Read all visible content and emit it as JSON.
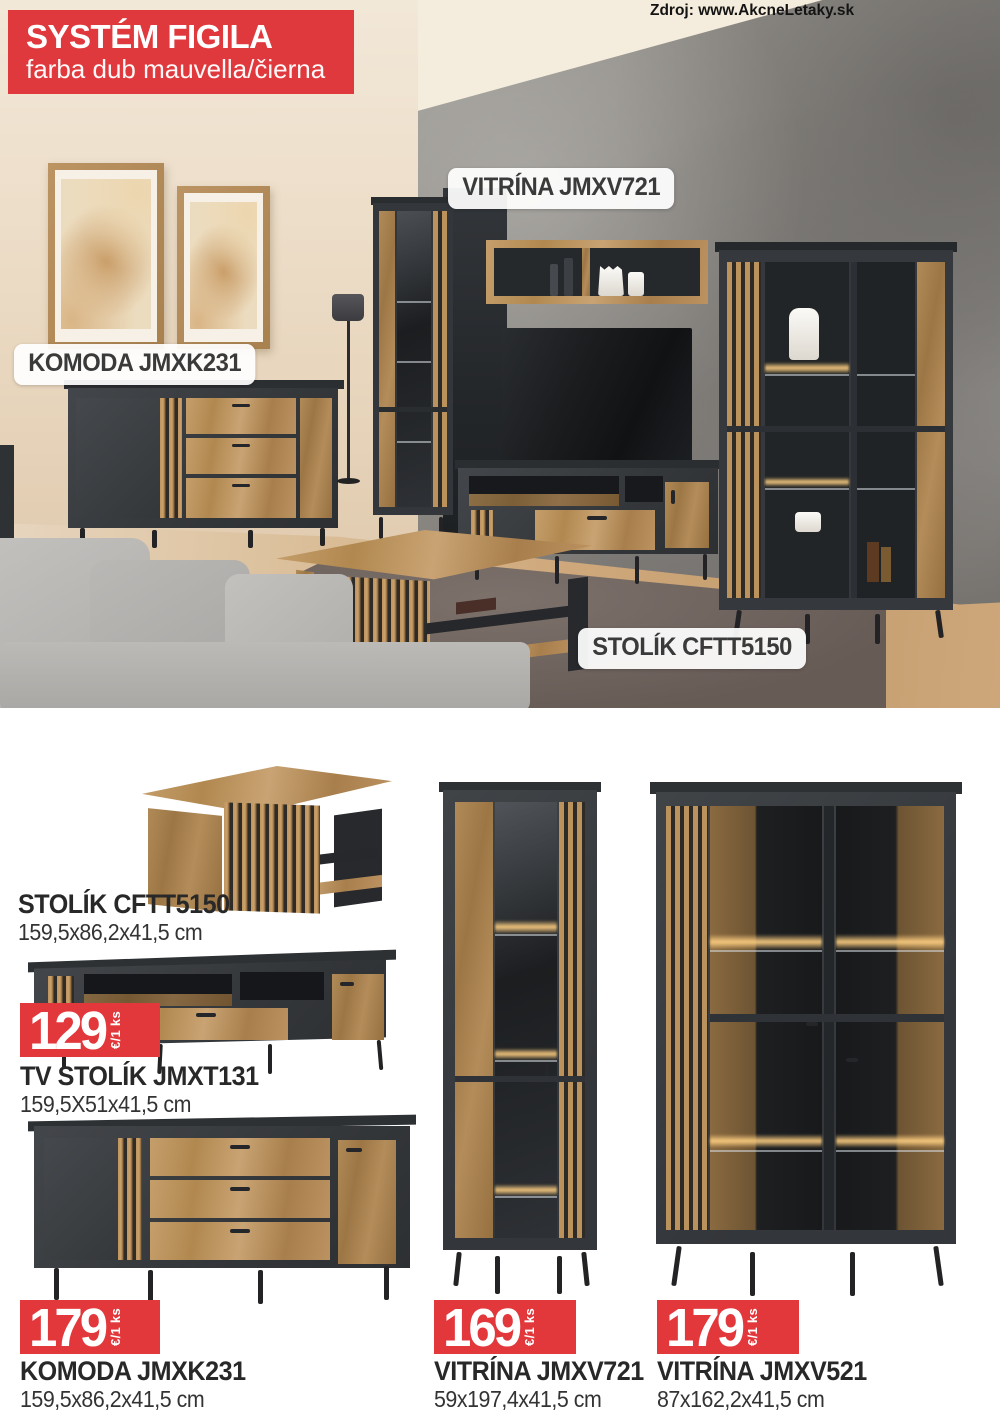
{
  "page": {
    "source_credit": "Zdroj: www.AkcneLetaky.sk"
  },
  "badge": {
    "title": "SYSTÉM FIGILA",
    "subtitle": "farba dub mauvella/čierna"
  },
  "photo": {
    "labels": [
      {
        "text": "VITRÍNA JMXV721"
      },
      {
        "text": "KOMODA JMXK231"
      },
      {
        "text": "STOLÍK CFTT5150"
      }
    ]
  },
  "products": [
    {
      "name": "STOLÍK CFTT5150",
      "dimensions": "159,5x86,2x41,5 cm"
    },
    {
      "name": "TV STOLÍK JMXT131",
      "dimensions": "159,5X51x41,5 cm",
      "price": "129",
      "price_unit": "€/1 ks"
    },
    {
      "name": "KOMODA JMXK231",
      "dimensions": "159,5x86,2x41,5 cm",
      "price": "179",
      "price_unit": "€/1 ks"
    },
    {
      "name": "VITRÍNA JMXV721",
      "dimensions": "59x197,4x41,5 cm",
      "price": "169",
      "price_unit": "€/1 ks"
    },
    {
      "name": "VITRÍNA JMXV521",
      "dimensions": "87x162,2x41,5 cm",
      "price": "179",
      "price_unit": "€/1 ks"
    }
  ],
  "colors": {
    "accent_red": "#e0393d",
    "furniture_dark": "#393c3f",
    "furniture_wood": "#bb9260",
    "concrete": "#8a8782"
  }
}
